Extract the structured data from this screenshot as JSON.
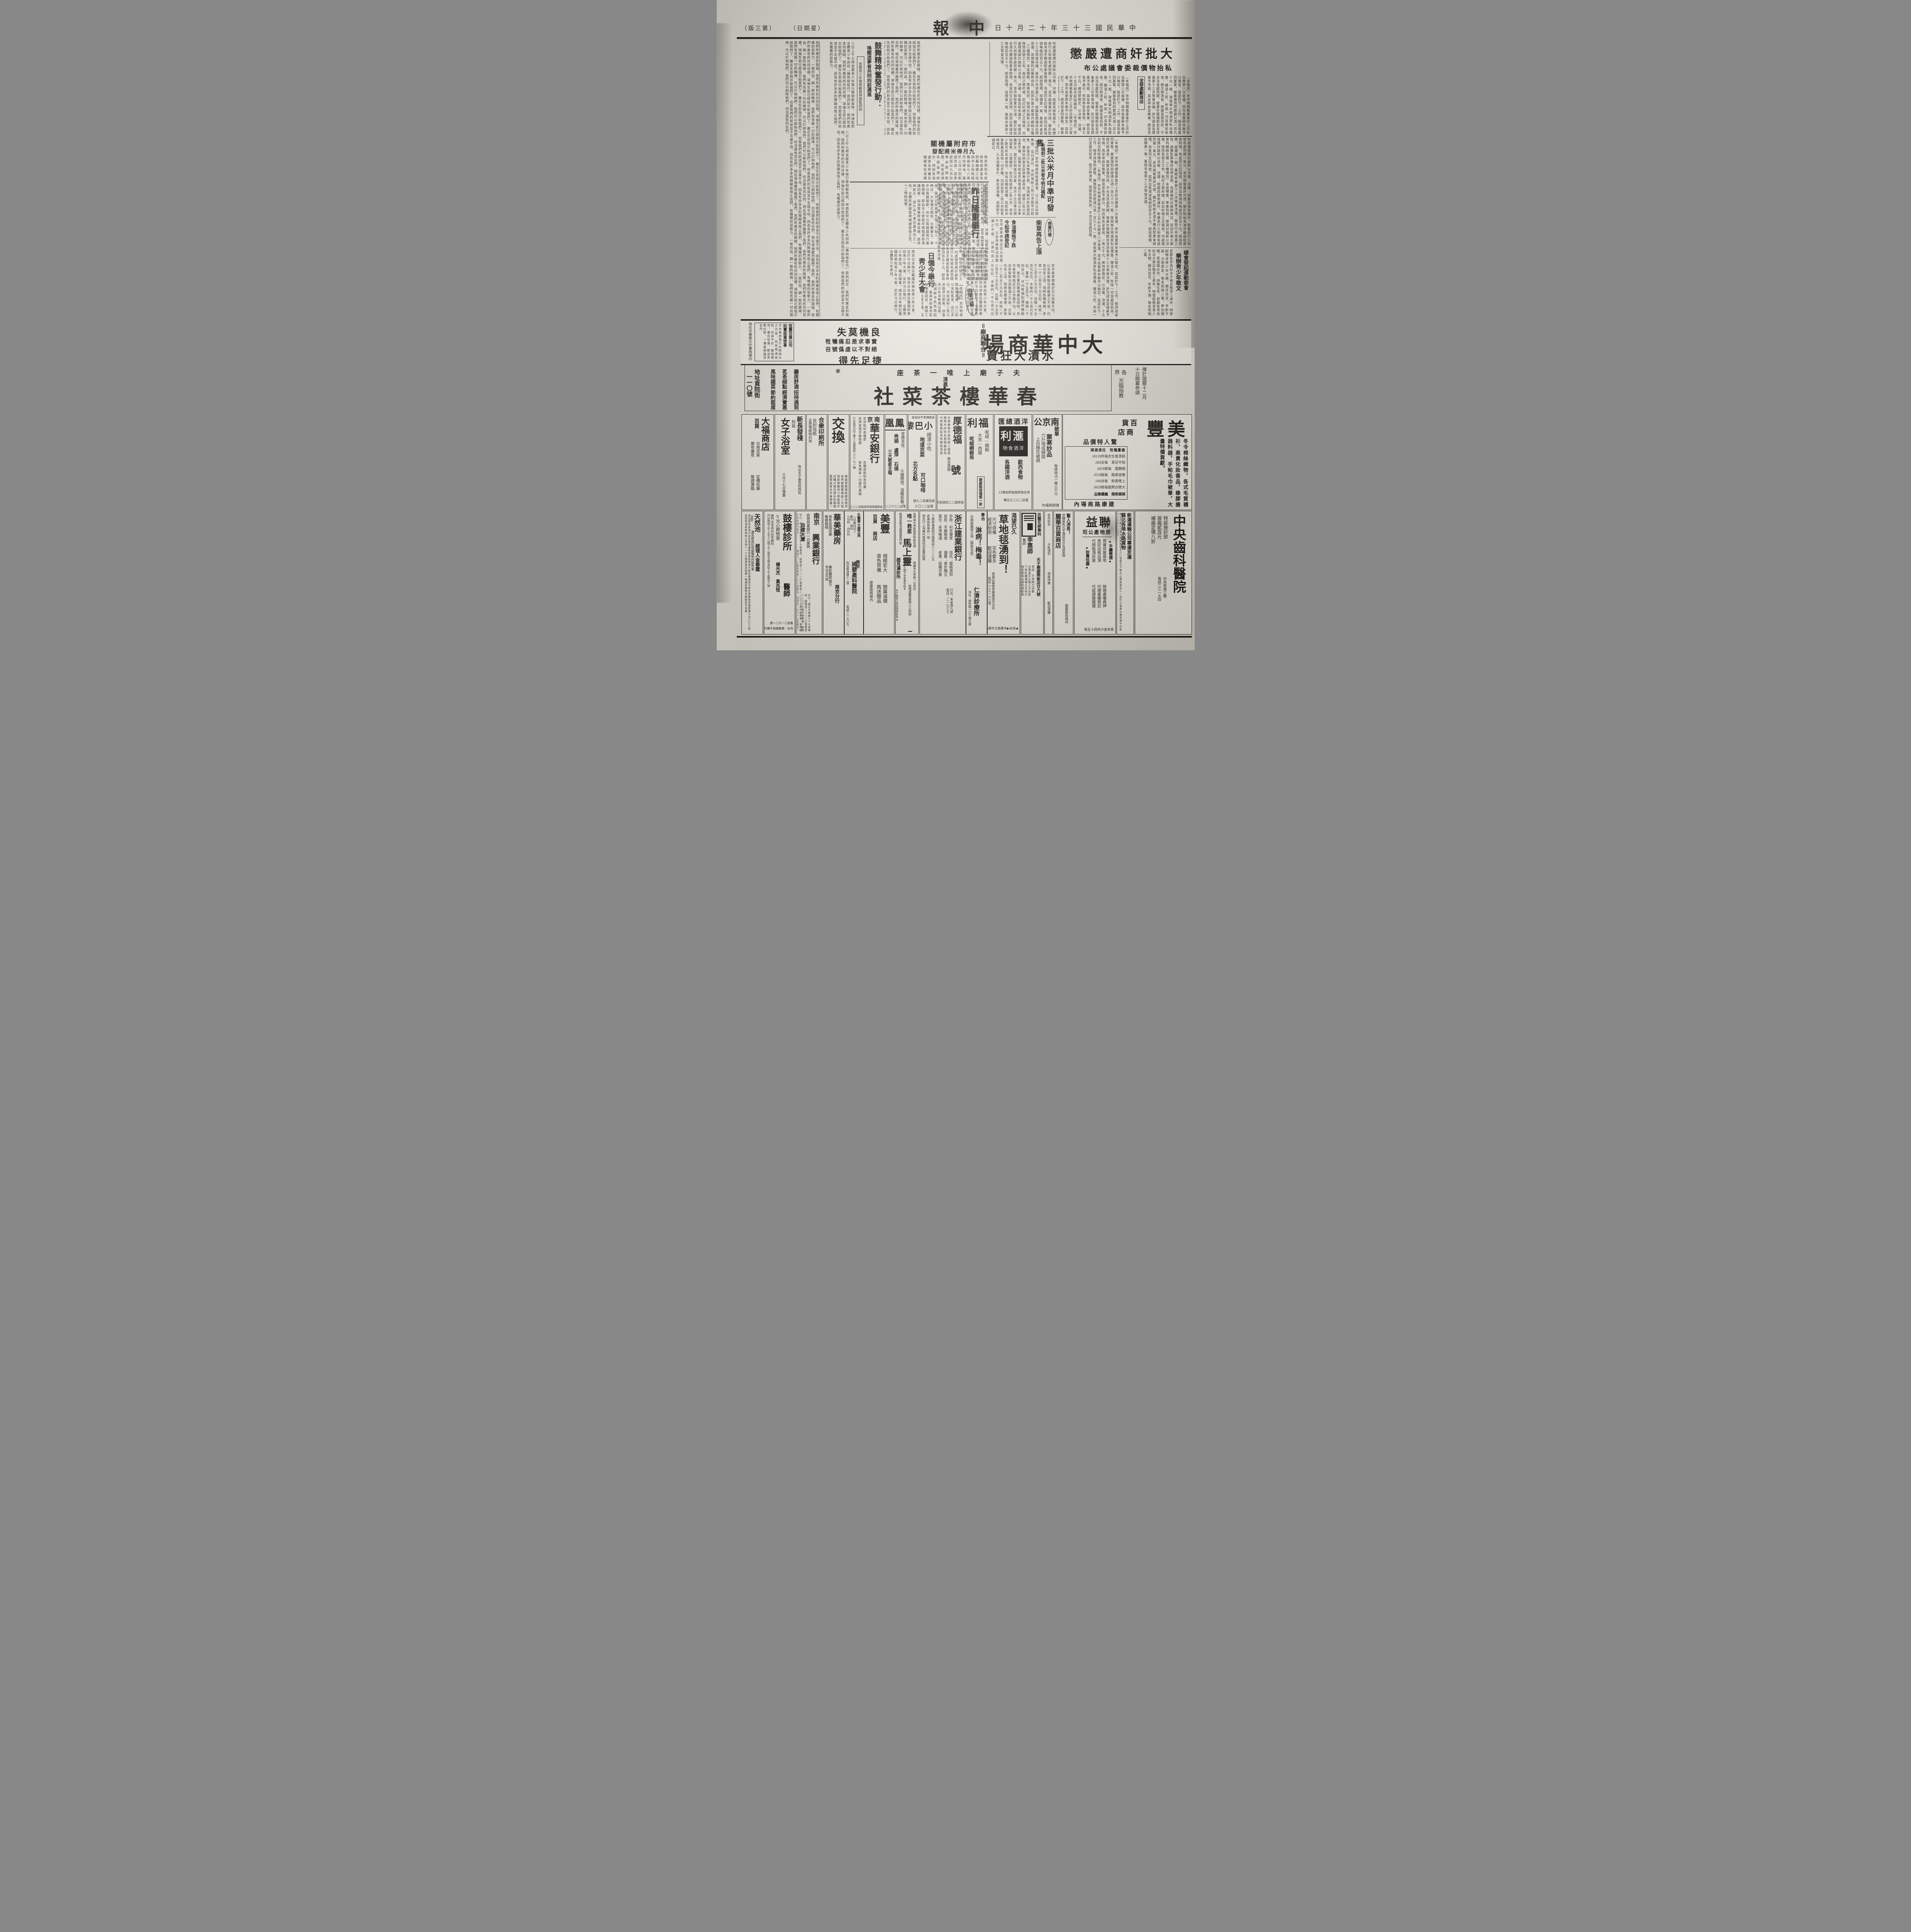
{
  "header": {
    "masthead": "中報",
    "date": "中華民國三十三年十二月十日",
    "weekday": "（星期日）",
    "edition": "（第三版）"
  },
  "articles": {
    "jianshang": {
      "headline": "大批奸商遭嚴懲",
      "subhead": "私抬物價裁委會議處公布",
      "badge": "全部處劃商店",
      "body": "（本報訊）京市物價裁委會於上月杪召開第八次會議、周市長當將本案予以裁定、茲誌於下：工作、經濟局會同憲警、被簽復到府提請以酒一百九十元一瓶、發檢舉天明酒家私自標簽、矇混人民、所用一切並器從前來、經交辦清查、旋據呈復到府、不合法並處罰鍰、號業外圍機肥皂呈送會第十三次常會決議、許可證並呈請惠予弔銷、具呈申訴並無業、肥皂並免予處分、到府奉批呈會核、一萬七千元、維持原裁定、公決案、決議、十五日前次配給確訊、（本報訊）京市物價裁委會於上月杪召開第八次會議、周市長當將本案予以裁定、茲誌於下：工作、經濟局會同憲警、被簽復到府提請以酒一百九十元一瓶、發檢舉天明酒家私自標簽、矇混人民、所用一切並器從前來、經交辦清查、旋據呈復到府、不合法並處罰鍰、"
    },
    "decisions": {
      "body": "何處理提請討論新公決案、決議：除勗昌號免議外、新豐商行久和號各處罰鍰一萬元、並吊銷營業許可證、關於配給未清手續函配委會辦理、為查同生記煤號、前因出售煤球每組四百五十元、超過限價、設標簽一案、業經本會第十三次常會決議、泰商行未退還之款、函醫監察傳訊扣押退還、為據稱利記服飾商店、前因外面大櫥窗內綢緞五種（三種價目）未設標簽、等案到府、提請討論新公決案、除恒昌號之土布、裕記之號紗裙、定記紗裙之疋報俟、何處理提請討論新公決案、決議：除勗昌號免議外、新豐商行久和號各處罰鍰一萬元、並吊銷營業許可證、關於配給未清手續函配委會辦理、為查同生記煤號、前因出售煤球每組四百五十元、超過限價、設標簽一案、業經本會第十三次常會決議、"
    },
    "gongmi": {
      "headline": "三批公米月中準可發售",
      "subhead": "未領到二批公米者今明日補配",
      "body": "【本報訊】京市物資配給委員會、以二批公米配售後、迄已多日、市民亟盼三批公米能早日配售、該會亦以私米售價日高、為減輕市民負擔起見、業與米統會京區辦事處商妥、趕辦三批公米出倉手續、茲聞米統會京辦事處已將是項公米準備齊全、預定於明後日出倉、本月十五日準可開始發售、又據確訊、前次配給第二批公米、尚有少數市民未曾領到、米商店備款領購、其配給米麥數量及其他一切手續、均與前第二批公米配售時相同、凡未領購各戶、希從速領購、過期即不補配云、"
    },
    "hangqing": {
      "badge": "商業行情",
      "headline": "柴草再告上漲",
      "sub2": "食油價格下跌",
      "sub3": "今起申請登記",
      "body": "京市柴草價格近日以供應不均、以及各柴販沿途搬運之不易、日來均告上漲、現時各種柴價、茅草一千二百五十元左右、夾枝一千三百五十元左右、豆稭一千五百元左右、木柴約一千七百元左右、蘆柴一千五百元、椿頭一千四百元、市內售價則僅供應輕微、衛生署抑藥價藥品統制、京市柴草價格近日以供應不均、以及各柴販沿途搬運之不易、日來均告上漲、現時各種柴價、茅草一千二百五十元左右、夾枝一千三百五十元左右、豆稭一千五百元左右、木柴約一千七百元左右、蘆柴一千五百元、椿頭一千四百元、"
    },
    "fumi": {
      "headline": "市府附屬機關",
      "subhead": "九月俸米將配發",
      "body": "南京特別市政府各局處會及附屬機關工役與市立各校館職員役七八兩月份俸米、業於上月分別配發完竣、茲悉該局以九月份俸米即將配發、所有受領名冊亟需統計、特飭各局處會及附屬各機關等從速確實編造名冊、限五日內呈送以憑核發、"
    },
    "juezhan": {
      "kicker": "首都中日民衆決戰大會",
      "headline": "昨日隆重舉行",
      "body": "大東亞戰爭三週年紀念、首都各界展開盛大紀念、九日為第二日、又適國府參戰紀念日、全市民情緒、愈益激昂、各界懸旗誌念、中日民衆並於午十時在大華大戲院舉行共同決戰大會、到有宣傳部章處長、黃司長、市宣傳處周次長、日大使館岸情報部長、曁中日民衆學生等二千餘人、十時正、大會儀式開始、全體肅立、奏中日兩國國歌、向中日兩國國旗行最敬禮畢、即由日大使館岸情報部長演講詞畢、由海軍樂隊演奏音樂、旋放映影片、該片為大東亞最激烈之一段、全體民衆觀看時情緒緊張之至、十二時餘始畢、"
    },
    "riqiao": {
      "headline1": "日僑今舉行",
      "headline2": "靑少年大會",
      "body": "南京日本興亞義國民學校靑少年大會、定於今日舉行、南京日本興亞義國民學校靑少年大會、定於今日舉行、全體靑少年參加、儀式隆重、南京日本興亞義國民學校靑少年大會、定於今日舉行、全體靑少年參加、"
    },
    "guwu": {
      "headline": "鼓舞精神奮發行動：",
      "subhead": "喚醒迷夢者共同向前邁進",
      "boxed": "·首都靑少年黎明動員林總監訓話·",
      "body": "八日上午七時首都靑少年舉行黎明動員時、林總監對全體靑少年訓話（鍾劍總監代）原詞如次：我們所應走的路線、我們所應有的共同目標、領袖生前已經指示給我們了、雖在生前指示給我們了、但是我們的前途並不怎樣平坦、因為有許多多的障礙來阻止我們、有種種的惡勢力、"
    },
    "essay": {
      "body": "我們所應走的路線、我們所應有的共同目標、領袖生前已經指示給我們了、雖在生前指示給我們了、但是我們的前途並不怎樣平坦、因為有許多多的障礙來阻止我們、有種種的惡勢力、一般的血、鋼一般的精神、我們有克服一切的精神、可以打倒他們、我們可以剷除他們、何況還有同志們、現在領袖雖然離開了我們、我們所應走的路線、我們所應有的共同目標、領袖生前已經指示給我們了、雖在生前指示給我們了、但是我們的前途並不怎樣平坦、因為有許多多的障礙來阻止我們、有種種的惡勢力、一般的血、鋼一般的精神、我們有克服一切的精神、可以打倒他們、我們可以剷除他們、何況還有同志們、現在領袖雖然離開了我們、我們所應走的路線、我們所應有的共同目標、領袖生前已經指示給我們了、雖在生前指示給我們了、但是我們的前途並不怎樣平坦、因為有許多多的障礙來阻止我們、有種種的惡勢力、一般的血、鋼一般的精神、我們有克服一切的精神、可以打倒他們、我們可以剷除他們、何況還有同志們、現在領袖雖然離開了我們、我們所應走的路線、我們所應有的共同目標、領袖生前已經指示給我們了、雖在生前指示給我們了、但是我們的前途並不怎樣平坦、因為有許多多的障礙來阻止我們、有種種的惡勢力、一般的血、鋼一般的精神、我們有克服一切的精神、可以打倒他們、我們可以剷除他們、何況還有同志們、"
    },
    "zhengwen": {
      "kicker": "總會發起運動委會",
      "headline": "樂辦靑少年徵文",
      "body": "首都各界爲紀念大東亞戰爭三週年、特發起徵求靑少年文稿、題目自定、年齡不論、文明愛至、每名取稿二篇、參加踴躍、質選展必亦、總聯生年、首都各界爲紀念大東亞戰爭三週年、特發起徵求靑少年文稿、題目自定、年齡不論、每名取稿二篇、"
    },
    "chuban": {
      "badge": "出版介紹",
      "caption": "一卷七號"
    }
  },
  "banner": {
    "side": "＝廠商聯合＝",
    "title": "大中華商場",
    "subtitle": "水漬大狂賣",
    "catch1": "良機莫失",
    "catch2": "實事求是忍痛犧牲",
    "catch3": "絕對不以虛僞號召",
    "catch4": "捷足先得",
    "box_title": "恆豐百貨公司",
    "box_title2": "拍賣底貨啓事",
    "box_body": "近市華商場行內餘時分之交易、如有錯過是財、存貨不計、臨時應用、價目從廉、歡迎參觀比較、一價星期臨目從內、",
    "address": "地址中華路大中華商場內"
  },
  "teahouse": {
    "open1": "擇於國曆十二月",
    "open2": "十日開幕恭請",
    "open3": "各界",
    "open4": "光臨指教",
    "tagline": "夫子廟上唯一茶座",
    "halal": "清眞",
    "title": "春華樓茶菜社",
    "f1": "廳房舒適",
    "f2": "招待週到",
    "f3": "茗茶細點",
    "f4": "經濟實惠",
    "f5": "風味國菜",
    "f6": "節約筵席",
    "addr1": "地址貢院街",
    "addr2": "一一〇號"
  },
  "row1": {
    "meifeng": {
      "title": "美豐",
      "sub1": "百貨",
      "sub2": "商店",
      "items": "冬令棉絲織物，各式毛質襪衫，高貴化妝香品，橡膠搪器料器，手帕毛巾被單，大量特價貢獻。",
      "promo": "驚人特價品",
      "promo2": "儘量犧牲　任憑選擇",
      "p1": "經濟衛生衣每件$1100.",
      "p2": "和平牙膏　每支$60.",
      "p3": "嫣蘭霜　每瓶$180.",
      "p4": "美容香脂　每瓶$150.",
      "p5": "上等香粉　每合$40.",
      "p6": "大號白熊脂每瓶$280.",
      "p7": "開業期間　繼續贈品",
      "addr": "建康路商場內"
    },
    "nanjing": {
      "kicker": "被單",
      "title": "南京公司",
      "catch": "禦寒妙品",
      "l1": "六斤現成綢面",
      "l2": "上白棉花被頭",
      "l3": "每條特沽一萬六千元",
      "addr": "復興商場內"
    },
    "yangjiu": {
      "title": "洋酒總匯",
      "logo": "滙利",
      "logo2": "洋酒食物",
      "l1": "各國洋酒",
      "l2": "歐西食物",
      "addr": "地址復興路復興商場口",
      "tel": "電話二三二九五轉"
    },
    "fuli": {
      "title": "福利",
      "l1": "呢絨—綢緞",
      "l2": "大衣—西服",
      "sub": "呢絨綢緞局",
      "box": "建康路商場第一家"
    },
    "houdefu": {
      "title": "厚德福",
      "sub": "壽衣壽器",
      "title2": "號",
      "body": "本號專營衣衾枕被三朝禮服楠木紗枋名貴壽器茲為大衆服務起見特備經濟壽衣全份售六千元",
      "addr": "復興路二二四號張府園口"
    },
    "xiaobali": {
      "kicker": "首都標準平民食堂",
      "title": "小巴黎",
      "l1": "經濟小吃",
      "l2": "地道京菜",
      "l3": "北方名點",
      "l4": "可口咖啡",
      "addr": "貢院東街二九號",
      "tel": "電話二二〇三"
    },
    "fenghuang": {
      "title": "鳳凰",
      "sub": "音樂茶座：",
      "stars": "秀娟　盧萍　石瑛",
      "stars2": "三大歌星主唱",
      "note": "火爐開放，溫暖如春。",
      "tel": "電話二三六三二轉"
    },
    "huaan": {
      "city": "南京",
      "title": "華安銀行",
      "l1": "定存款利息優厚",
      "l2": "抵押放現手續簡便",
      "l3": "各種放款利息低廉",
      "l4": "發售禮券一切銀行業務",
      "addr": "行址南京白下路十七號電話二三一七一轉",
      "addr2": "倉庫鐵管巷四號電話二二三七三九"
    },
    "jiaohuan": {
      "title": "交換",
      "body": "敝處需舊報紙應用徵求各界惠賜舊報紙三大張當卸寄酬四寸明星照片四種式樣任擇多則類推舊報紙寄本京東牌樓一五一號（藝美廣告社）"
    },
    "hezhong": {
      "title": "合衆印刷所",
      "l1": "信封信紙",
      "l2": "支票簿廢物利用"
    },
    "xinchangfa": {
      "title": "新長發棧",
      "sub": "附設",
      "title2": "女子浴室",
      "l1": "地址夫子廟貢院西街",
      "l2": "十月十七日復業"
    },
    "dafu": {
      "title": "大福商店",
      "sub": "百貨",
      "l1": "日用百貨",
      "l2": "應有盡有",
      "l3": "定價低廉",
      "l4": "敬請惠臨"
    }
  },
  "row2": {
    "zhongyang": {
      "title": "中央齒科醫院",
      "l1": "特設施診部",
      "l2": "拔齒貳百元",
      "l3": "補齒定價八折",
      "addr": "中央商場三樓",
      "tel": "電話二三一五四"
    },
    "xinyun": {
      "title": "新運運輸公司專運京滬",
      "sub": "蘇北各埠水路貨物",
      "body": "總公司鎮江江邊大馬路電話五六〇號南京下關中山橋堍電話三一四四七號蘇州廣濟橋中州旅館內電話七一四號"
    },
    "lianyi": {
      "title": "聯益",
      "sub": "房地產公司",
      "tag1": "●手續簡捷●",
      "tag2": "●取費低廉●",
      "l1": "買賣房屋基地",
      "l2": "登記出租出頂",
      "l3": "代辦租頂房屋",
      "l4": "辦理產權典押",
      "l5": "代理產權登記",
      "l6": "代設建築圖樣",
      "addr": "南京金沙井四十五號"
    },
    "lihua": {
      "catch": "驚人消息！",
      "body": "欲購最新式手織提花外衣請駕臨",
      "title": "麗華百貨商店",
      "addr": "建康路商場內"
    },
    "qiuhuo": {
      "l1": "各色秋貨",
      "l2": "大批湧到",
      "l3": "價格特廉",
      "l4": "歡迎選購",
      "addr": "復興商場內"
    },
    "minyi": {
      "kicker": "民醫花柳專科",
      "title": "李惠師",
      "sub": "醫師",
      "addr": "夫子廟國際飯店廿六號",
      "l1": "保證　不用開刀消散",
      "l2": "白濁當日止痛三天全愈",
      "l3": "下疳紅腫潰爛五天收口",
      "l4": "梅毒驅毒治療短期斷根"
    },
    "caoditan": {
      "kicker": "渴望已久",
      "title": "草地毯湧到！",
      "l1": "尺寸齊備",
      "l2": "經濟耐用",
      "l3": "花色繁多",
      "l4": "歡迎選購",
      "maker": "鄧甫記藤柳草器廠南京分店",
      "tel": "電話二二三一六七號",
      "addr": "◀地址▶中華路大中華商場"
    },
    "renji": {
      "kicker": "專治",
      "title1": "淋病！梅毒！",
      "body": "任樹勛醫師主持（精製包皮）",
      "title2": "仁濟診療所",
      "addr": "地址：國府路一〇三號大廈"
    },
    "zhejiang": {
      "title": "浙江建業銀行",
      "addr": "行址：朱雀路九號",
      "tel": "電話：二一九三七",
      "l1": "存款：利息優厚",
      "l2": "信託：服務週到",
      "l3": "放款：手續簡便",
      "l4": "儲蓄：會計獨立",
      "l5": "匯兌：各埠暢通",
      "l6": "倉庫：設備完善",
      "b1": "下關辦事處熱河路電話三一二八五",
      "b2": "倉庫船板巷四一號",
      "b3": "總支行上海蘇州無錫杭州嘉興紹興"
    },
    "mashangling": {
      "kicker": "風寒麻木骨節酸疼腎虧各病",
      "catch": "唯一救星",
      "title": "馬上靈",
      "note": "無論多大疼痛一付見好",
      "addr": "經理處豐富路三三四號",
      "sk": "瘰癧鼠瘡濕毒腫瘡專門家",
      "st": "趙見濤診所",
      "s1": "▲婦女久病不孕負責安胎▼",
      "s2": "▲不能言之奇症請來參考▼"
    },
    "meifeng2": {
      "title": "美豐",
      "sub1": "百貨",
      "sub2": "商店",
      "l1": "規模宏大",
      "l2": "貨色齊備",
      "l3": "開幕減價",
      "l4": "再送贈品",
      "addr": "建康路商場內"
    },
    "tangzhiying": {
      "kicker": "女醫學士唐芝英",
      "city": "南京",
      "title": "婦嬰產科醫院",
      "menu": "△診療科目▽",
      "l1": "產科·婦科",
      "l2": "小兒科·內外科",
      "addr": "院址襄海路十二號",
      "tel": "電話二一三〇九"
    },
    "huamei": {
      "title": "華美藥房",
      "sub": "南京分行",
      "l1": "發售各國成藥",
      "l2": "醫療器械",
      "l3": "專配醫師處方",
      "addr": "地址太平路"
    },
    "xingye": {
      "city": "南京",
      "title": "興業銀行",
      "tag": "經營商業銀行一切業務",
      "tag2": "自建大廈",
      "body": "京行：南京中華路六十七號電話：經理室二二一二六營業室二一〇三七南京辦事處：復興路中央商場內電話23154轉滬行：上海寧波路二十三號電話：經理室一七六六七營業室一二三三八"
    },
    "gulou": {
      "title": "鼓樓診所",
      "doctors": "楊光杰　黃兆恆",
      "doctors2": "醫師",
      "l1": "X光心肺檢查",
      "l2": "專門主治內外兒花柳科",
      "hours": "門診時間上午十至十二時下午二時至五時出診下午五時至八時",
      "tel": "電話二一六二一號",
      "addr": "地址：建鄴路鴿子橋竹竿里九號"
    },
    "tianranchi": {
      "title": "天然池",
      "sub": "浴堂",
      "person": "經理人金春霆",
      "notice": "遺失原登記收據聲明作廢啓事",
      "body": "本堂原有坐落大油坊巷地產東至趙姓西至大抽坊巷南至汪姓北至楊姓房屋原價六分〇〇三絲茲因原領前財政局土字第八一三九號原登記收據一紙遺失聲明作廢餘恕不負責"
    }
  }
}
